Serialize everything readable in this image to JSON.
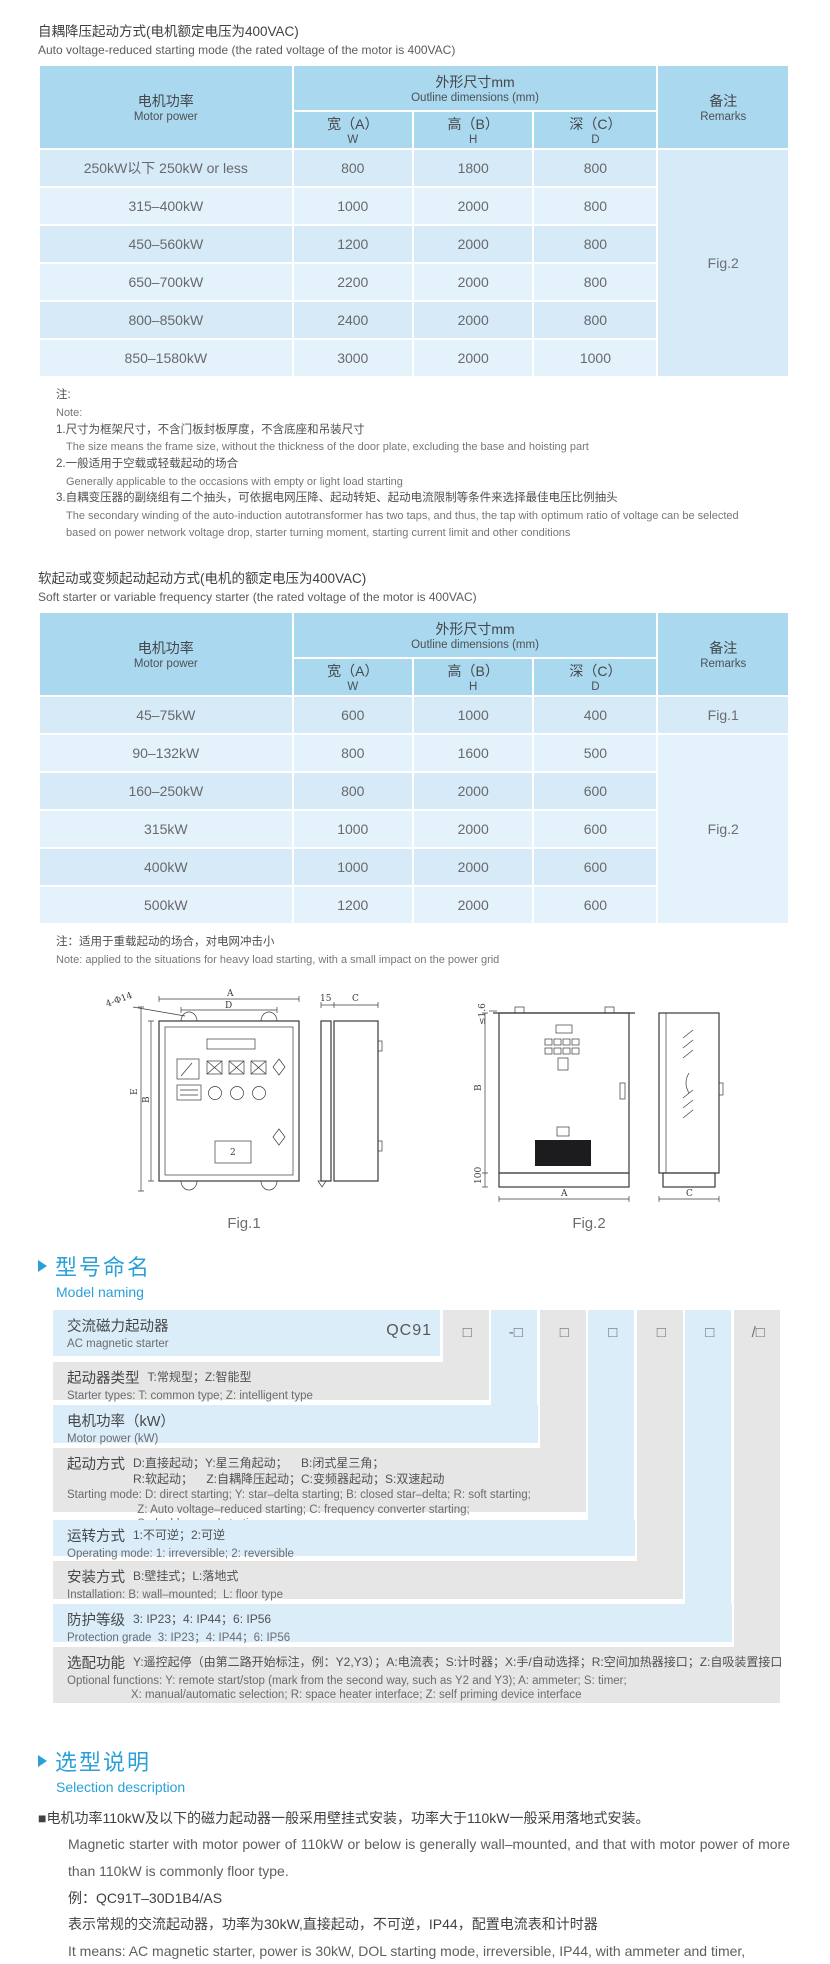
{
  "colors": {
    "accent_blue": "#2aa0d8",
    "table_header_bg": "#a9d8ef",
    "row_dark": "#d6eaf7",
    "row_light": "#e4f2fb",
    "band_blue": "#daedf9",
    "band_gray": "#e6e6e7",
    "text_gray": "#68696d"
  },
  "section1": {
    "title_zh": "自耦降压起动方式(电机额定电压为400VAC)",
    "title_en": "Auto voltage-reduced starting mode (the rated voltage of the motor is 400VAC)"
  },
  "dim_header": {
    "motor_zh": "电机功率",
    "motor_en": "Motor power",
    "dims_zh": "外形尺寸mm",
    "dims_en": "Outline dimensions (mm)",
    "w_zh": "宽（A）",
    "w_unit": "W",
    "h_zh": "高（B）",
    "h_unit": "H",
    "d_zh": "深（C）",
    "d_unit": "D",
    "remarks_zh": "备注",
    "remarks_en": "Remarks"
  },
  "table1": {
    "rows": [
      {
        "power": "250kW以下 250kW or less",
        "w": "800",
        "h": "1800",
        "d": "800"
      },
      {
        "power": "315–400kW",
        "w": "1000",
        "h": "2000",
        "d": "800"
      },
      {
        "power": "450–560kW",
        "w": "1200",
        "h": "2000",
        "d": "800"
      },
      {
        "power": "650–700kW",
        "w": "2200",
        "h": "2000",
        "d": "800"
      },
      {
        "power": "800–850kW",
        "w": "2400",
        "h": "2000",
        "d": "800"
      },
      {
        "power": "850–1580kW",
        "w": "3000",
        "h": "2000",
        "d": "1000"
      }
    ],
    "remarks_cells": [
      {
        "row": 0,
        "span": 6,
        "text": "Fig.2"
      }
    ]
  },
  "notes1": {
    "label_zh": "注:",
    "label_en": "Note:",
    "items": [
      {
        "zh": "1.尺寸为框架尺寸，不含门板封板厚度，不含底座和吊装尺寸",
        "en": "The size means the frame size, without the thickness of the door plate, excluding the base and hoisting part"
      },
      {
        "zh": "2.一般适用于空载或轻载起动的场合",
        "en": "Generally applicable to the occasions with empty or light load starting"
      },
      {
        "zh": "3.自耦变压器的副绕组有二个抽头，可依据电网压降、起动转矩、起动电流限制等条件来选择最佳电压比例抽头",
        "en": "The secondary winding of the auto-induction autotransformer has two taps, and thus, the tap with optimum ratio of voltage can be selected based on power network voltage drop, starter turning moment, starting current limit and other conditions"
      }
    ]
  },
  "section2": {
    "title_zh": "软起动或变频起动起动方式(电机的额定电压为400VAC)",
    "title_en": "Soft starter or variable frequency starter (the rated voltage of the motor is 400VAC)"
  },
  "table2": {
    "rows": [
      {
        "power": "45–75kW",
        "w": "600",
        "h": "1000",
        "d": "400"
      },
      {
        "power": "90–132kW",
        "w": "800",
        "h": "1600",
        "d": "500"
      },
      {
        "power": "160–250kW",
        "w": "800",
        "h": "2000",
        "d": "600"
      },
      {
        "power": "315kW",
        "w": "1000",
        "h": "2000",
        "d": "600"
      },
      {
        "power": "400kW",
        "w": "1000",
        "h": "2000",
        "d": "600"
      },
      {
        "power": "500kW",
        "w": "1200",
        "h": "2000",
        "d": "600"
      }
    ],
    "remarks_cells": [
      {
        "row": 0,
        "span": 1,
        "text": "Fig.1"
      },
      {
        "row": 1,
        "span": 5,
        "text": "Fig.2"
      }
    ]
  },
  "note2": {
    "zh": "注：适用于重载起动的场合，对电网冲击小",
    "en": "Note: applied to the situations for heavy load starting, with a small impact on the power grid"
  },
  "figures": {
    "fig1": {
      "caption": "Fig.1",
      "labels": {
        "a": "A",
        "d": "D",
        "holes": "4-Φ14",
        "e": "E",
        "b": "B",
        "off": "15",
        "c": "C",
        "tag": "2"
      }
    },
    "fig2": {
      "caption": "Fig.2",
      "labels": {
        "thick": "≤1.6",
        "b": "B",
        "base": "100",
        "a": "A",
        "c": "C"
      }
    }
  },
  "model_naming": {
    "header_zh": "型号命名",
    "header_en": "Model naming",
    "code_prefix": "QC91",
    "code_boxes": [
      "□",
      "-□",
      "□",
      "□",
      "□",
      "□",
      "/□"
    ],
    "rows": [
      {
        "label_zh": "交流磁力起动器",
        "label_en": "AC magnetic starter"
      },
      {
        "label_zh": "起动器类型",
        "desc_zh": "T:常规型；Z:智能型",
        "en": "Starter types: T: common type; Z: intelligent type"
      },
      {
        "label_zh": "电机功率（kW）",
        "desc_zh": "",
        "en": "Motor power (kW)"
      },
      {
        "label_zh": "起动方式",
        "desc_zh": "D:直接起动；Y:星三角起动；    B:闭式星三角；\nR:软起动；    Z:自耦降压起动；C:变频器起动；S:双速起动",
        "en": "Starting mode: D: direct starting; Y: star–delta starting; B: closed star–delta; R: soft starting;\n                      Z: Auto voltage–reduced starting; C: frequency converter starting;\n                      S: double speed starting"
      },
      {
        "label_zh": "运转方式",
        "desc_zh": "1:不可逆；2:可逆",
        "en": "Operating mode: 1: irreversible; 2: reversible"
      },
      {
        "label_zh": "安装方式",
        "desc_zh": "B:壁挂式；L:落地式",
        "en": "Installation: B: wall–mounted;  L: floor type"
      },
      {
        "label_zh": "防护等级",
        "desc_zh": "3: IP23；4: IP44；6: IP56",
        "en": "Protection grade  3: IP23；4: IP44；6: IP56"
      },
      {
        "label_zh": "选配功能",
        "desc_zh": "Y:遥控起停（由第二路开始标注，例：Y2,Y3）；A:电流表；S:计时器；X:手/自动选择；R:空间加热器接口；Z:自吸装置接口",
        "en": "Optional functions: Y: remote start/stop (mark from the second way, such as Y2 and Y3); A: ammeter; S: timer;\n                    X: manual/automatic selection; R: space heater interface; Z: self priming device interface"
      }
    ]
  },
  "selection": {
    "header_zh": "选型说明",
    "header_en": "Selection description",
    "p1_zh": "■电机功率110kW及以下的磁力起动器一般采用壁挂式安装，功率大于110kW一般采用落地式安装。",
    "p1_en": "Magnetic starter with motor power of 110kW or below is generally wall–mounted, and that with motor power of more than 110kW is commonly floor type.",
    "example_label": "例：QC91T–30D1B4/AS",
    "example_zh": "表示常规的交流起动器，功率为30kW,直接起动，不可逆，IP44，配置电流表和计时器",
    "example_en": "It means: AC magnetic starter, power is 30kW, DOL starting mode, irreversible, IP44, with ammeter and timer,"
  }
}
